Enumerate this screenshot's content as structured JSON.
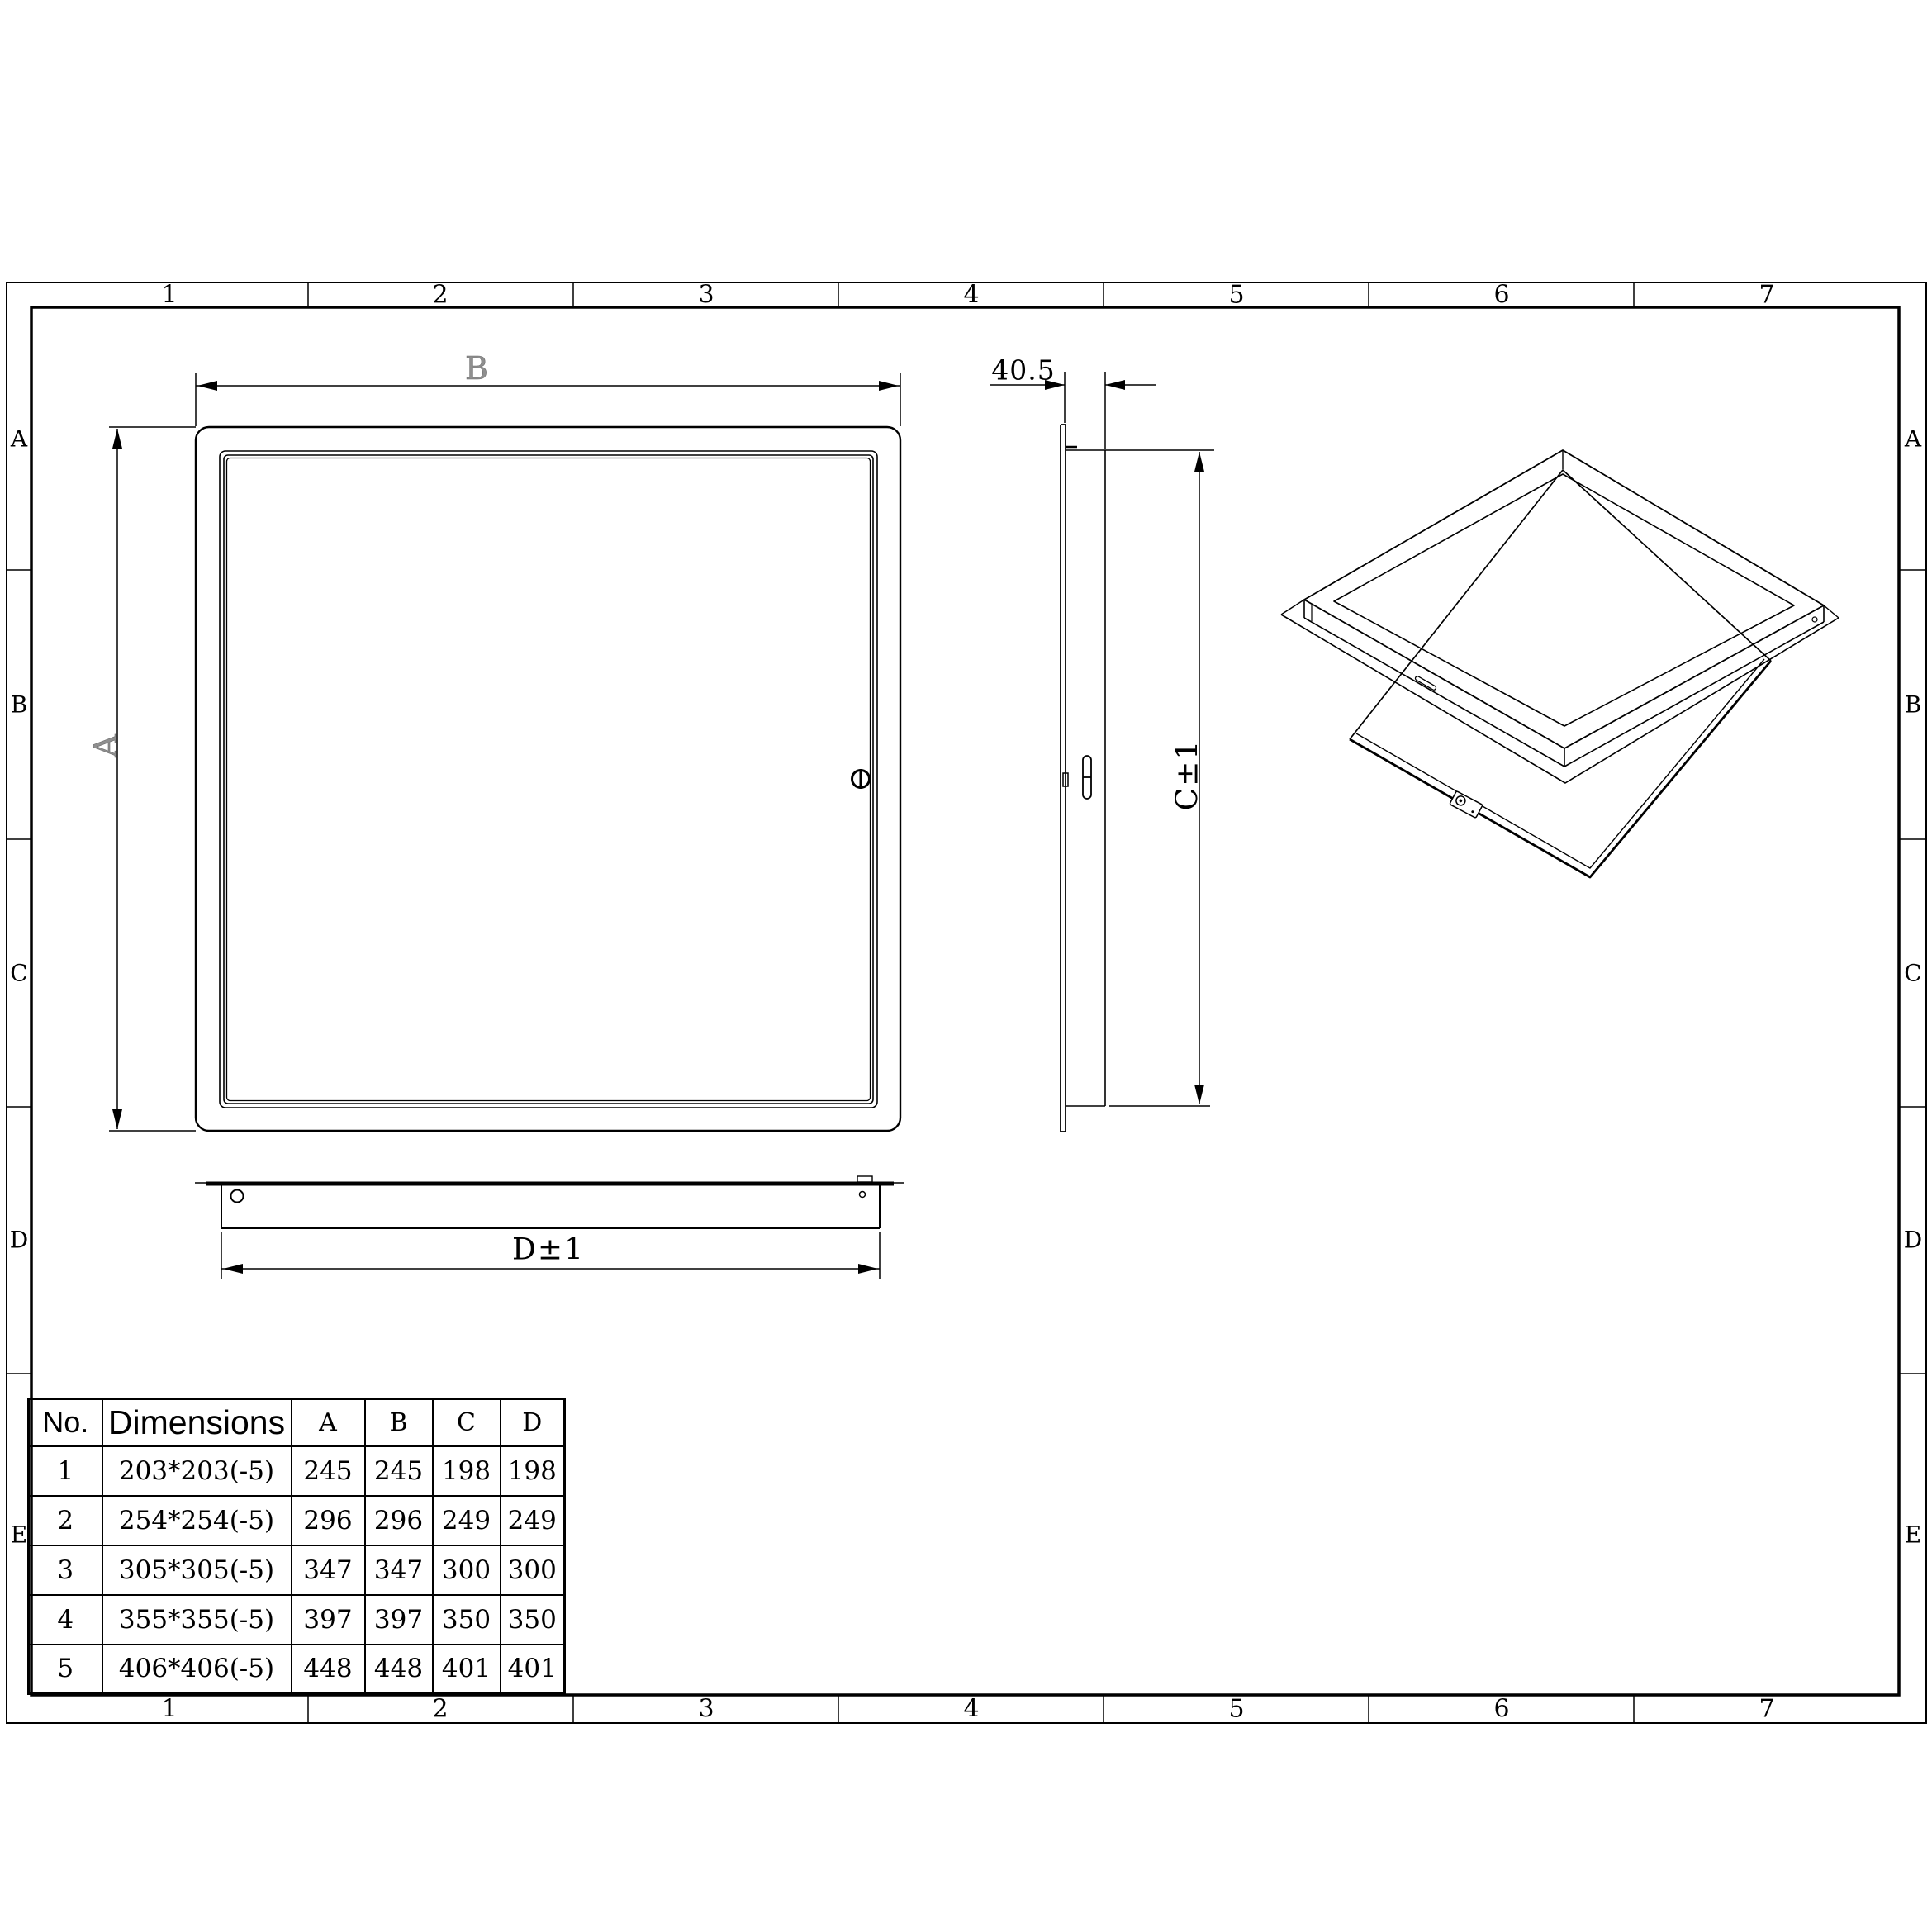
{
  "drawing": {
    "type": "access-panel engineering drawing"
  },
  "grid": {
    "cols": [
      "1",
      "2",
      "3",
      "4",
      "5",
      "6",
      "7"
    ],
    "rows": [
      "A",
      "B",
      "C",
      "D",
      "E"
    ]
  },
  "front_view": {
    "width_label": "B",
    "height_label": "A"
  },
  "side_view": {
    "depth_label": "40.5",
    "height_label": "C±1"
  },
  "bottom_view": {
    "width_label": "D±1"
  },
  "table": {
    "headers": {
      "no": "No.",
      "dimensions": "Dimensions",
      "a": "A",
      "b": "B",
      "c": "C",
      "d": "D"
    },
    "rows": [
      {
        "no": "1",
        "dimensions": "203*203(-5)",
        "a": "245",
        "b": "245",
        "c": "198",
        "d": "198"
      },
      {
        "no": "2",
        "dimensions": "254*254(-5)",
        "a": "296",
        "b": "296",
        "c": "249",
        "d": "249"
      },
      {
        "no": "3",
        "dimensions": "305*305(-5)",
        "a": "347",
        "b": "347",
        "c": "300",
        "d": "300"
      },
      {
        "no": "4",
        "dimensions": "355*355(-5)",
        "a": "397",
        "b": "397",
        "c": "350",
        "d": "350"
      },
      {
        "no": "5",
        "dimensions": "406*406(-5)",
        "a": "448",
        "b": "448",
        "c": "401",
        "d": "401"
      }
    ]
  },
  "colors": {
    "line": "#000000",
    "ghost_label": "#8f8f8f",
    "background": "#ffffff"
  }
}
